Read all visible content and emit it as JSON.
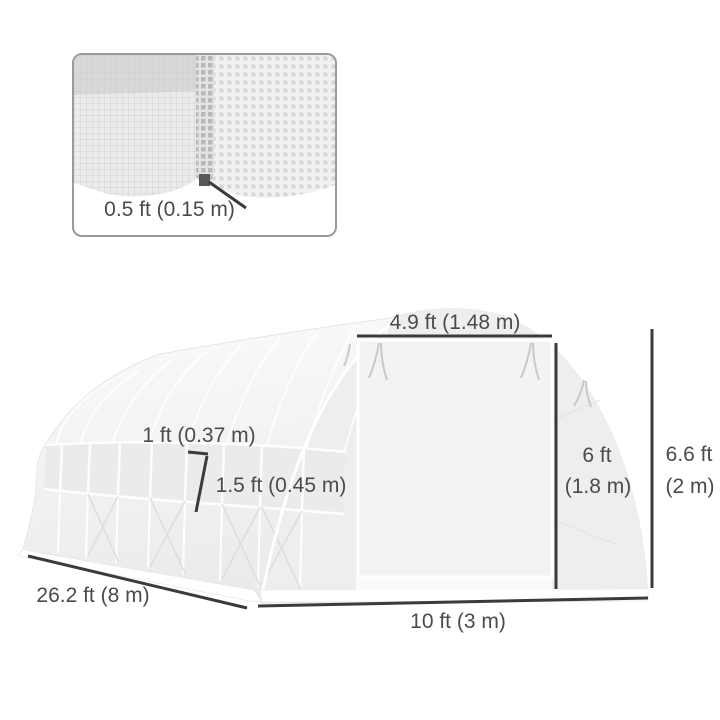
{
  "image_type": "greenhouse-dimensions-diagram",
  "inset": {
    "label": "0.5 ft (0.15 m)"
  },
  "dimensions": {
    "door_width": "4.9 ft (1.48 m)",
    "window_width": "1 ft (0.37 m)",
    "window_height": "1.5 ft (0.45 m)",
    "door_height_line1": "6 ft",
    "door_height_line2": "(1.8 m)",
    "total_height_line1": "6.6 ft",
    "total_height_line2": "(2 m)",
    "length": "26.2 ft (8 m)",
    "width": "10 ft (3 m)"
  },
  "colors": {
    "background": "#ffffff",
    "dimension_line": "#3b3b3b",
    "label_text": "#4b4b4b",
    "inset_border": "#9a9a9a",
    "stake_marker": "#575757",
    "fabric_light": "#f4f4f4",
    "fabric_mid": "#ececec"
  }
}
